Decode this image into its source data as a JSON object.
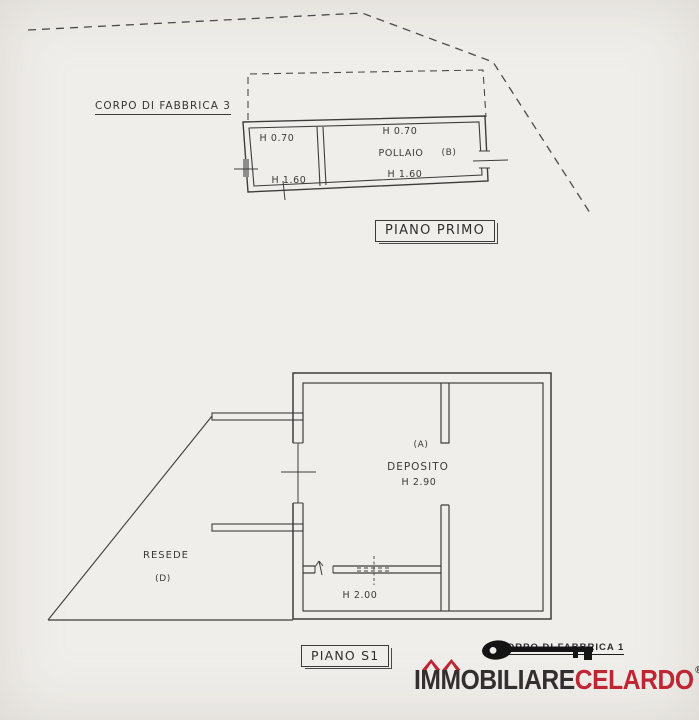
{
  "canvas": {
    "background": "#f0eeea",
    "ink": "#3d3d3d"
  },
  "upper_plan": {
    "corpo_label": "CORPO DI FABBRICA 3",
    "floor_title": "PIANO PRIMO",
    "left_room": {
      "height_top": "H 0.70",
      "height_bottom": "H 1.60"
    },
    "main_room": {
      "height_top": "H 0.70",
      "name": "POLLAIO",
      "unit": "(B)",
      "height_bottom": "H 1.60"
    }
  },
  "lower_plan": {
    "floor_title": "PIANO S1",
    "unit": "(A)",
    "room_name": "DEPOSITO",
    "room_height": "H 2.90",
    "storage_height": "H 2.00",
    "yard_name": "RESEDE",
    "yard_unit": "(D)"
  },
  "footer": {
    "corpo_label": "CORPO DI FABBRICA 1",
    "brand_part1": "IMMOBILIARE",
    "brand_part2": "CELARDO",
    "registered": "®"
  },
  "colors": {
    "brand_dark": "#332f30",
    "brand_red": "#bf2533"
  }
}
